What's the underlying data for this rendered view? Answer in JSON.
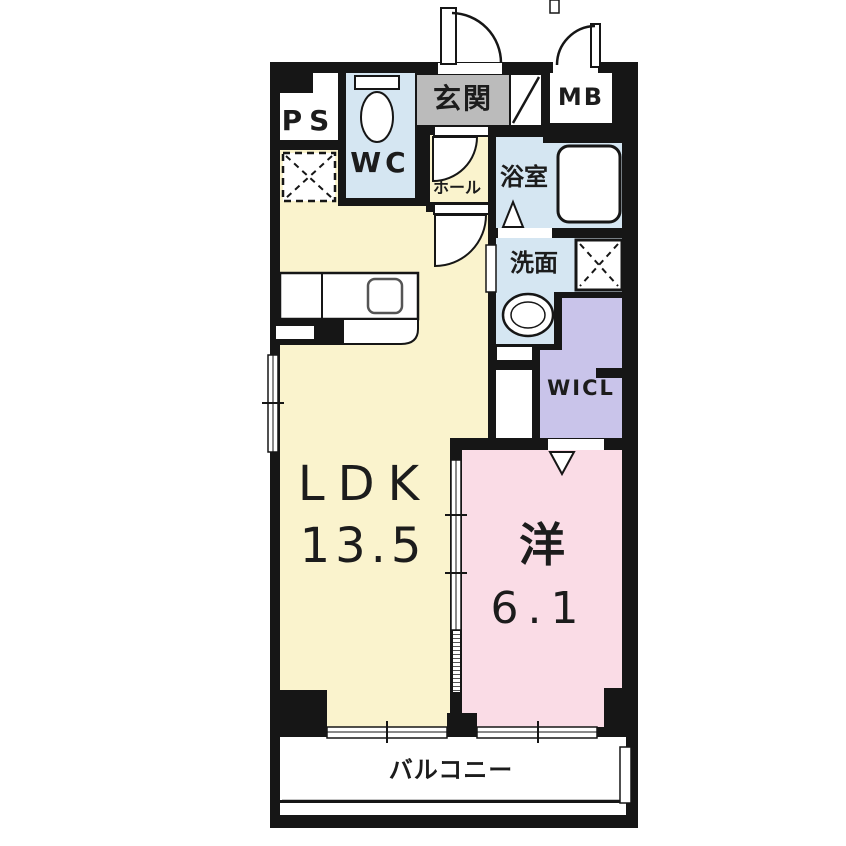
{
  "rooms": {
    "ps": {
      "label": "PS"
    },
    "wc": {
      "label": "WC"
    },
    "genkan": {
      "label": "玄関"
    },
    "mb": {
      "label": "MB"
    },
    "hall": {
      "label": "ホール"
    },
    "bathroom": {
      "label": "浴室"
    },
    "washroom": {
      "label": "洗面"
    },
    "wicl": {
      "label": "WICL"
    },
    "ldk": {
      "label": "LDK",
      "area": "13.5"
    },
    "western": {
      "label": "洋",
      "area": "6.1"
    },
    "balcony": {
      "label": "バルコニー"
    }
  },
  "fixtures": [
    "entrance-swing-door",
    "meter-box-swing-door",
    "shoe-cabinet-slash",
    "hall-swing-door-upper",
    "hall-swing-door-lower",
    "toilet",
    "refrigerator-space-dashed-x",
    "kitchen-counter-with-sink",
    "bathtub",
    "bathroom-folding-door-triangle",
    "washing-machine-space-x",
    "wash-basin",
    "wicl-folding-door-triangle",
    "left-wall-window",
    "sliding-partition-door",
    "balcony-sliding-window-left",
    "balcony-sliding-window-right"
  ],
  "colors": {
    "wall": "#161616",
    "room_yellow": "#FAF3CD",
    "room_blue": "#D5E6F2",
    "room_lavender": "#C9C4EA",
    "room_pink": "#FADCE6",
    "genkan_gray": "#BBBBBB",
    "background": "#FFFFFF"
  }
}
